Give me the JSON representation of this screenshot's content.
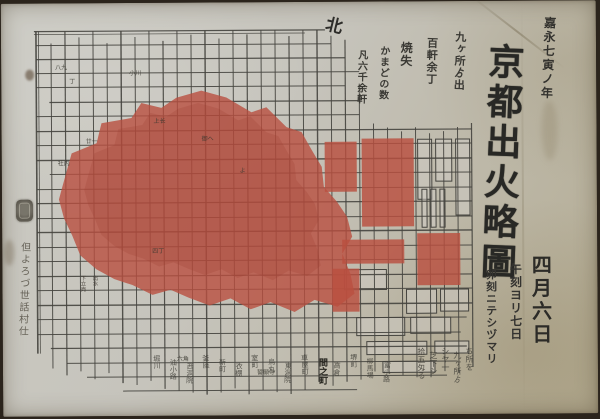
{
  "photo": {
    "backing_color": "#2b241c",
    "paper_color": "#c6c4bc",
    "paper_shadow_color": "#b3ab92",
    "burn_wash_color": "#b94f40",
    "ink_color": "#45443f"
  },
  "compass": {
    "north_label": "北"
  },
  "title_block": {
    "era_date": "嘉永七寅ノ年",
    "title": "京都出火略圖",
    "stats_columns": [
      "九ヶ所ゟ出",
      "百軒余丁",
      "焼失",
      "かまどの数",
      "凡六千余軒"
    ]
  },
  "date_block": {
    "date_main": "四月六日",
    "date_sub1": "午刻ヨリ七日",
    "date_sub2": "卯刻ニテシヅマリ"
  },
  "notes_columns": [
    "ち所を",
    "九ヶ所ゟ",
    "シヤ一",
    "芝下シ",
    "拾五匁る"
  ],
  "left_annotation": {
    "seal_name": "publisher-seal",
    "text": "但よろづ世話村仕"
  },
  "street_labels_bottom": [
    "堀川",
    "油小路",
    "西洞院",
    "釜座",
    "新町",
    "衣棚",
    "室町",
    "烏丸",
    "東洞院",
    "車屋町",
    "間之町",
    "高倉",
    "堺町",
    "柳馬場",
    "富小路"
  ],
  "map": {
    "block_labels": [
      {
        "x": 30,
        "y": 46,
        "t": "八九"
      },
      {
        "x": 44,
        "y": 60,
        "t": "丁"
      },
      {
        "x": 104,
        "y": 52,
        "t": "小川"
      },
      {
        "x": 128,
        "y": 100,
        "t": "上长"
      },
      {
        "x": 176,
        "y": 118,
        "t": "御へ"
      },
      {
        "x": 60,
        "y": 120,
        "t": "廿一"
      },
      {
        "x": 32,
        "y": 142,
        "t": "社内"
      },
      {
        "x": 126,
        "y": 230,
        "t": "四丁"
      },
      {
        "x": 214,
        "y": 150,
        "t": "よ"
      },
      {
        "x": 150,
        "y": 338,
        "t": "六角"
      },
      {
        "x": 230,
        "y": 352,
        "t": "誓願寺"
      }
    ],
    "inner_street_labels": [
      {
        "x": 56,
        "y": 252,
        "t": "下立売"
      },
      {
        "x": 68,
        "y": 252,
        "t": "出水"
      }
    ]
  }
}
